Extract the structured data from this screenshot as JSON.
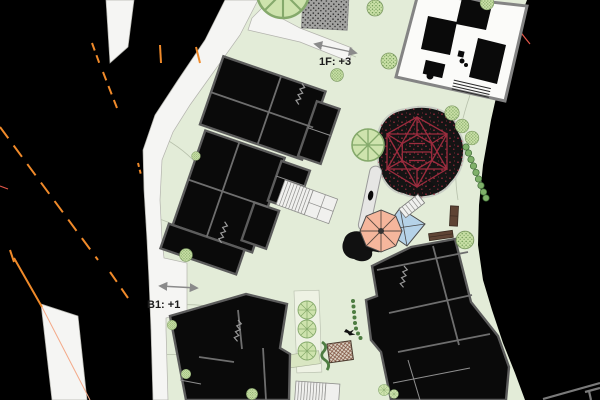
{
  "labels": {
    "floor_upper": "1F: +3",
    "floor_lower": "B1: +1"
  },
  "features": [
    "context-buildings",
    "streets",
    "site-lawn",
    "school-building-cluster",
    "roof-plan-1f",
    "basement-level-b1",
    "climbing-net-playground",
    "umbrella-canopy",
    "blue-canopy",
    "slide",
    "play-stair",
    "pergola",
    "benches",
    "gravel-area",
    "stairs",
    "trees",
    "shrubs",
    "hedges"
  ],
  "colors": {
    "site-green": "#e3ecd8",
    "road-white": "#f5f5f3",
    "outside-black": "#000000",
    "wall-gray": "#5c5c5c",
    "building-black": "#0a0a0a",
    "plan-white": "#fbfbf9",
    "plan-wall-gray": "#848484",
    "core-black": "#0a0a0a",
    "orange-dash": "#f08a2a",
    "salmon-line": "#f4a988",
    "red-line": "#e05548",
    "net-red": "#9c2c3e",
    "net-base": "#141414",
    "net-rim": "#c9cec5",
    "umbrella-salmon": "#f5b69c",
    "umbrella-spoke": "#5a4a42",
    "canopy-blue": "#b5d2e8",
    "slide-gray": "#e6e6e4",
    "slide-edge": "#9a9a9a",
    "tree-fill": "#cee3ad",
    "tree-line": "#85a96b",
    "shrub-fill": "#c9dfa6",
    "shrub-dot": "#6f9a55",
    "hedge-green": "#7fb06a",
    "hedge-dark": "#4e7d42",
    "gravel-gray": "#a3a3a1",
    "gravel-dot": "#1a1a1a",
    "pergola-bg": "#ddd5c6",
    "pergola-line": "#7a4a38",
    "pergola-edge": "#4a3a2e",
    "bench-brown": "#5f4434",
    "stair-fill": "#f0f0ee",
    "stair-line": "#8f8f8d",
    "contour": "#b7c0ab",
    "label-ink": "#1c1c1c",
    "arrow-gray": "#8a8a8a",
    "bed-pale": "#eef2e4",
    "bed-green": "#d9e6c2",
    "glyph-black": "#111111"
  }
}
